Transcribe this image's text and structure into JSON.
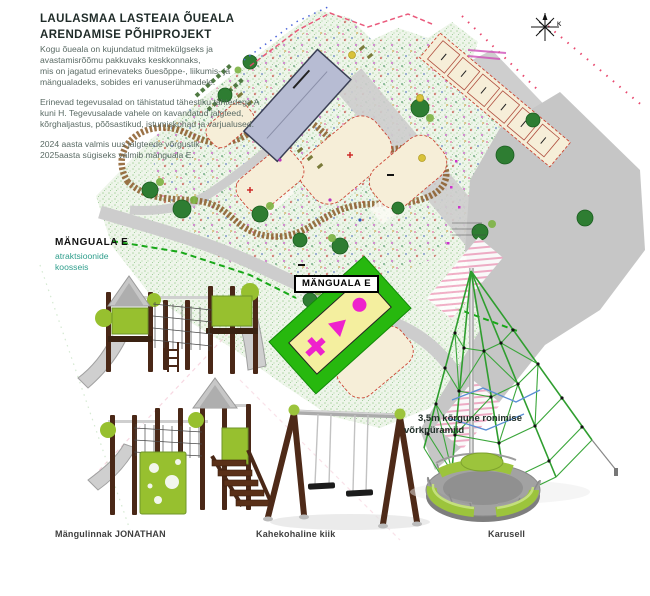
{
  "poster": {
    "title_line1": "LAULASMAA LASTEAIA ÕUEALA",
    "title_line2": "ARENDAMISE PÕHIPROJEKT",
    "intro": [
      "Kogu õueala on kujundatud mitmekülgseks ja",
      "avastamisrõõmu pakkuvaks keskkonnaks,",
      "mis on jagatud erinevateks õuesõppe-, liikumis- ja",
      "mängualadeks, sobides eri vanuserühmadele."
    ],
    "zones": [
      "Erinevad tegevusalad on tähistatud tähestiku tähtedega A",
      "kuni H. Tegevusalade vahele on kavandatud jalgteed,",
      "kõrghaljastus, põõsastikud, istumiskohad ja varjualused."
    ],
    "status": [
      "2024 aasta valmis uus jalgteede võrgustik.",
      "2025aasta sügiseks valmib mänguala E."
    ]
  },
  "plan": {
    "highlight_label": "MÄNGUALA E",
    "compass_label": "K"
  },
  "area_callout": {
    "title": "MÄNGUALA E",
    "sub_line1": "atraktsioonide",
    "sub_line2": "koosseis"
  },
  "pyramid_note": {
    "line1": "3,5m kõrgune ronimise",
    "line2": "võrkpüramiid"
  },
  "equipment_captions": [
    {
      "label": "Mängulinnak JONATHAN"
    },
    {
      "label": "Kahekohaline kiik"
    },
    {
      "label": "Karusell"
    }
  ],
  "colors": {
    "highlight_green": "#27b80e",
    "equipment_green": "#9cc43c",
    "wood_brown": "#4e2a18",
    "callout_teal": "#2f9e8c",
    "plan_sand": "#f6eed8",
    "boundary_red": "#e8486e"
  }
}
